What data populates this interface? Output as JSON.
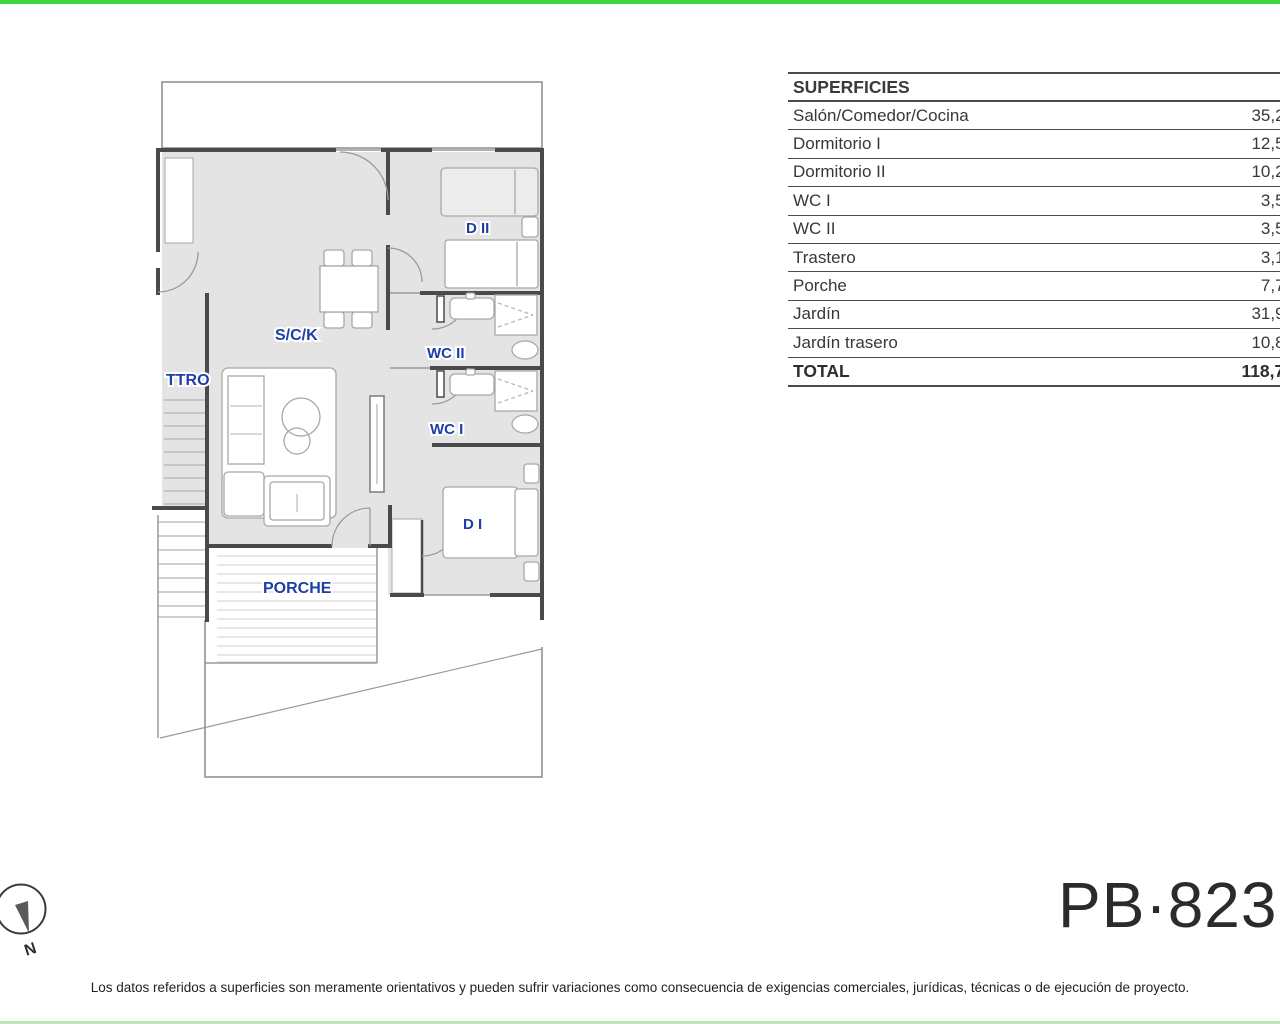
{
  "accents": {
    "top_bar_color": "#3ed63c",
    "bottom_bar_color": "#b6e7b4",
    "label_blue": "#1d3fa5"
  },
  "floor_plan": {
    "labels": {
      "living": "S/C/K",
      "trastero": "TTRO",
      "bedroom2": "D II",
      "wc2": "WC II",
      "wc1": "WC I",
      "bedroom1": "D I",
      "porch": "PORCHE"
    }
  },
  "surfaces_table": {
    "header": "SUPERFICIES",
    "rows": [
      {
        "label": "Salón/Comedor/Cocina",
        "value": "35,20"
      },
      {
        "label": "Dormitorio I",
        "value": "12,50"
      },
      {
        "label": "Dormitorio II",
        "value": "10,23"
      },
      {
        "label": "WC I",
        "value": "3,55"
      },
      {
        "label": "WC II",
        "value": "3,55"
      },
      {
        "label": "Trastero",
        "value": "3,19"
      },
      {
        "label": "Porche",
        "value": "7,70"
      },
      {
        "label": "Jardín",
        "value": "31,95"
      },
      {
        "label": "Jardín trasero",
        "value": "10,83"
      }
    ],
    "total": {
      "label": "TOTAL",
      "value": "118,70"
    }
  },
  "compass": {
    "north_label": "N"
  },
  "plan_code": "PB·823",
  "disclaimer": "Los datos referidos a superficies son meramente orientativos y pueden sufrir variaciones como consecuencia de exigencias comerciales, jurídicas, técnicas o de ejecución de proyecto."
}
